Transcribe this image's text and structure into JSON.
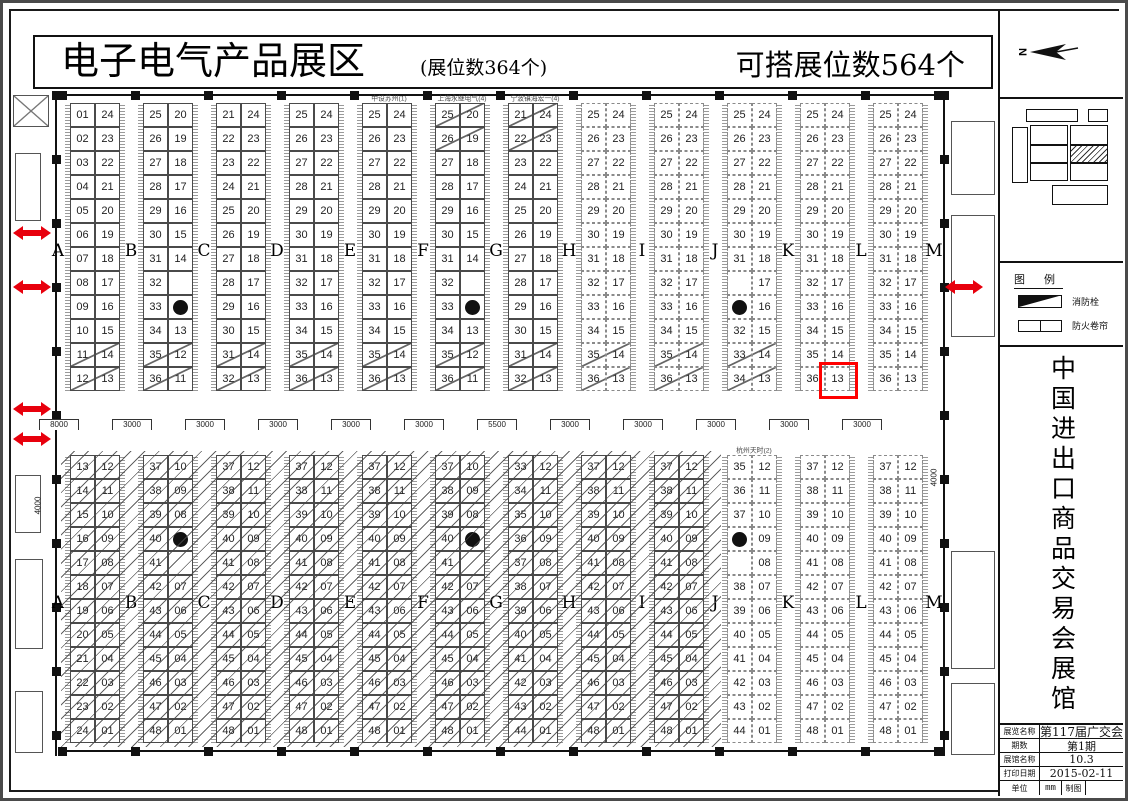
{
  "banner": {
    "title": "电子电气产品展区",
    "subtitle": "(展位数364个)",
    "right_title": "可搭展位数564个"
  },
  "letters": [
    "A",
    "B",
    "C",
    "D",
    "E",
    "F",
    "G",
    "H",
    "I",
    "J",
    "K",
    "L",
    "M"
  ],
  "top_blocks": [
    {
      "id": "A-B",
      "style": "solid",
      "header": "",
      "slash": [
        10,
        11
      ],
      "rows": [
        [
          "01",
          "24"
        ],
        [
          "02",
          "23"
        ],
        [
          "03",
          "22"
        ],
        [
          "04",
          "21"
        ],
        [
          "05",
          "20"
        ],
        [
          "06",
          "19"
        ],
        [
          "07",
          "18"
        ],
        [
          "08",
          "17"
        ],
        [
          "09",
          "16"
        ],
        [
          "10",
          "15"
        ],
        [
          "11",
          "14"
        ],
        [
          "12",
          "13"
        ]
      ]
    },
    {
      "id": "B-C",
      "style": "solid",
      "header": "",
      "slash": [
        10,
        11
      ],
      "rows": [
        [
          "25",
          "20"
        ],
        [
          "26",
          "19"
        ],
        [
          "27",
          "18"
        ],
        [
          "28",
          "17"
        ],
        [
          "29",
          "16"
        ],
        [
          "30",
          "15"
        ],
        [
          "31",
          "14"
        ],
        [
          "32",
          ""
        ],
        [
          "33",
          "P"
        ],
        [
          "34",
          "13"
        ],
        [
          "35",
          "12"
        ],
        [
          "36",
          "11"
        ]
      ]
    },
    {
      "id": "C-D",
      "style": "solid",
      "header": "",
      "slash": [
        10,
        11
      ],
      "rows": [
        [
          "21",
          "24"
        ],
        [
          "22",
          "23"
        ],
        [
          "23",
          "22"
        ],
        [
          "24",
          "21"
        ],
        [
          "25",
          "20"
        ],
        [
          "26",
          "19"
        ],
        [
          "27",
          "18"
        ],
        [
          "28",
          "17"
        ],
        [
          "29",
          "16"
        ],
        [
          "30",
          "15"
        ],
        [
          "31",
          "14"
        ],
        [
          "32",
          "13"
        ]
      ]
    },
    {
      "id": "D-E",
      "style": "solid",
      "header": "",
      "slash": [
        10,
        11
      ],
      "rows": [
        [
          "25",
          "24"
        ],
        [
          "26",
          "23"
        ],
        [
          "27",
          "22"
        ],
        [
          "28",
          "21"
        ],
        [
          "29",
          "20"
        ],
        [
          "30",
          "19"
        ],
        [
          "31",
          "18"
        ],
        [
          "32",
          "17"
        ],
        [
          "33",
          "16"
        ],
        [
          "34",
          "15"
        ],
        [
          "35",
          "14"
        ],
        [
          "36",
          "13"
        ]
      ]
    },
    {
      "id": "E-F",
      "style": "solid",
      "header": "中设苏州(1)",
      "slash": [
        10,
        11
      ],
      "rows": [
        [
          "25",
          "24"
        ],
        [
          "26",
          "23"
        ],
        [
          "27",
          "22"
        ],
        [
          "28",
          "21"
        ],
        [
          "29",
          "20"
        ],
        [
          "30",
          "19"
        ],
        [
          "31",
          "18"
        ],
        [
          "32",
          "17"
        ],
        [
          "33",
          "16"
        ],
        [
          "34",
          "15"
        ],
        [
          "35",
          "14"
        ],
        [
          "36",
          "13"
        ]
      ]
    },
    {
      "id": "F-G",
      "style": "solid",
      "header": "上海永继电气(4)",
      "slash": [
        0,
        1,
        10,
        11
      ],
      "rows": [
        [
          "25",
          "20"
        ],
        [
          "26",
          "19"
        ],
        [
          "27",
          "18"
        ],
        [
          "28",
          "17"
        ],
        [
          "29",
          "16"
        ],
        [
          "30",
          "15"
        ],
        [
          "31",
          "14"
        ],
        [
          "32",
          ""
        ],
        [
          "33",
          "P"
        ],
        [
          "34",
          "13"
        ],
        [
          "35",
          "12"
        ],
        [
          "36",
          "11"
        ]
      ]
    },
    {
      "id": "G-H",
      "style": "solid",
      "header": "宁波镇海宏一(4)",
      "slash": [
        0,
        1,
        10,
        11
      ],
      "rows": [
        [
          "21",
          "24"
        ],
        [
          "22",
          "23"
        ],
        [
          "23",
          "22"
        ],
        [
          "24",
          "21"
        ],
        [
          "25",
          "20"
        ],
        [
          "26",
          "19"
        ],
        [
          "27",
          "18"
        ],
        [
          "28",
          "17"
        ],
        [
          "29",
          "16"
        ],
        [
          "30",
          "15"
        ],
        [
          "31",
          "14"
        ],
        [
          "32",
          "13"
        ]
      ]
    },
    {
      "id": "H-I",
      "style": "dashed",
      "header": "",
      "slash": [
        10,
        11
      ],
      "rows": [
        [
          "25",
          "24"
        ],
        [
          "26",
          "23"
        ],
        [
          "27",
          "22"
        ],
        [
          "28",
          "21"
        ],
        [
          "29",
          "20"
        ],
        [
          "30",
          "19"
        ],
        [
          "31",
          "18"
        ],
        [
          "32",
          "17"
        ],
        [
          "33",
          "16"
        ],
        [
          "34",
          "15"
        ],
        [
          "35",
          "14"
        ],
        [
          "36",
          "13"
        ]
      ]
    },
    {
      "id": "I-J",
      "style": "dashed",
      "header": "",
      "slash": [
        10,
        11
      ],
      "rows": [
        [
          "25",
          "24"
        ],
        [
          "26",
          "23"
        ],
        [
          "27",
          "22"
        ],
        [
          "28",
          "21"
        ],
        [
          "29",
          "20"
        ],
        [
          "30",
          "19"
        ],
        [
          "31",
          "18"
        ],
        [
          "32",
          "17"
        ],
        [
          "33",
          "16"
        ],
        [
          "34",
          "15"
        ],
        [
          "35",
          "14"
        ],
        [
          "36",
          "13"
        ]
      ]
    },
    {
      "id": "J-K",
      "style": "dashed",
      "header": "",
      "slash": [
        10,
        11
      ],
      "rows": [
        [
          "25",
          "24"
        ],
        [
          "26",
          "23"
        ],
        [
          "27",
          "22"
        ],
        [
          "28",
          "21"
        ],
        [
          "29",
          "20"
        ],
        [
          "30",
          "19"
        ],
        [
          "31",
          "18"
        ],
        [
          "",
          "17"
        ],
        [
          "P",
          "16"
        ],
        [
          "32",
          "15"
        ],
        [
          "33",
          "14"
        ],
        [
          "34",
          "13"
        ]
      ]
    },
    {
      "id": "K-L",
      "style": "dashed",
      "header": "",
      "slash": [],
      "rows": [
        [
          "25",
          "24"
        ],
        [
          "26",
          "23"
        ],
        [
          "27",
          "22"
        ],
        [
          "28",
          "21"
        ],
        [
          "29",
          "20"
        ],
        [
          "30",
          "19"
        ],
        [
          "31",
          "18"
        ],
        [
          "32",
          "17"
        ],
        [
          "33",
          "16"
        ],
        [
          "34",
          "15"
        ],
        [
          "35",
          "14"
        ],
        [
          "36",
          "13"
        ]
      ],
      "highlight": [
        11,
        1
      ]
    },
    {
      "id": "L-M",
      "style": "dashed",
      "header": "",
      "slash": [],
      "rows": [
        [
          "25",
          "24"
        ],
        [
          "26",
          "23"
        ],
        [
          "27",
          "22"
        ],
        [
          "28",
          "21"
        ],
        [
          "29",
          "20"
        ],
        [
          "30",
          "19"
        ],
        [
          "31",
          "18"
        ],
        [
          "32",
          "17"
        ],
        [
          "33",
          "16"
        ],
        [
          "34",
          "15"
        ],
        [
          "35",
          "14"
        ],
        [
          "36",
          "13"
        ]
      ]
    }
  ],
  "bottom_blocks": [
    {
      "id": "A-B",
      "style": "solid",
      "hatched": true,
      "header": "",
      "rows": [
        [
          "13",
          "12"
        ],
        [
          "14",
          "11"
        ],
        [
          "15",
          "10"
        ],
        [
          "16",
          "09"
        ],
        [
          "17",
          "08"
        ],
        [
          "18",
          "07"
        ],
        [
          "19",
          "06"
        ],
        [
          "20",
          "05"
        ],
        [
          "21",
          "04"
        ],
        [
          "22",
          "03"
        ],
        [
          "23",
          "02"
        ],
        [
          "24",
          "01"
        ]
      ]
    },
    {
      "id": "B-C",
      "style": "solid",
      "hatched": true,
      "header": "",
      "rows": [
        [
          "37",
          "10"
        ],
        [
          "38",
          "09"
        ],
        [
          "39",
          "08"
        ],
        [
          "40",
          "P"
        ],
        [
          "41",
          ""
        ],
        [
          "42",
          "07"
        ],
        [
          "43",
          "06"
        ],
        [
          "44",
          "05"
        ],
        [
          "45",
          "04"
        ],
        [
          "46",
          "03"
        ],
        [
          "47",
          "02"
        ],
        [
          "48",
          "01"
        ]
      ]
    },
    {
      "id": "C-D",
      "style": "solid",
      "hatched": true,
      "header": "",
      "rows": [
        [
          "37",
          "12"
        ],
        [
          "38",
          "11"
        ],
        [
          "39",
          "10"
        ],
        [
          "40",
          "09"
        ],
        [
          "41",
          "08"
        ],
        [
          "42",
          "07"
        ],
        [
          "43",
          "06"
        ],
        [
          "44",
          "05"
        ],
        [
          "45",
          "04"
        ],
        [
          "46",
          "03"
        ],
        [
          "47",
          "02"
        ],
        [
          "48",
          "01"
        ]
      ]
    },
    {
      "id": "D-E",
      "style": "solid",
      "hatched": true,
      "header": "",
      "rows": [
        [
          "37",
          "12"
        ],
        [
          "38",
          "11"
        ],
        [
          "39",
          "10"
        ],
        [
          "40",
          "09"
        ],
        [
          "41",
          "08"
        ],
        [
          "42",
          "07"
        ],
        [
          "43",
          "06"
        ],
        [
          "44",
          "05"
        ],
        [
          "45",
          "04"
        ],
        [
          "46",
          "03"
        ],
        [
          "47",
          "02"
        ],
        [
          "48",
          "01"
        ]
      ]
    },
    {
      "id": "E-F",
      "style": "solid",
      "hatched": true,
      "header": "",
      "rows": [
        [
          "37",
          "12"
        ],
        [
          "38",
          "11"
        ],
        [
          "39",
          "10"
        ],
        [
          "40",
          "09"
        ],
        [
          "41",
          "08"
        ],
        [
          "42",
          "07"
        ],
        [
          "43",
          "06"
        ],
        [
          "44",
          "05"
        ],
        [
          "45",
          "04"
        ],
        [
          "46",
          "03"
        ],
        [
          "47",
          "02"
        ],
        [
          "48",
          "01"
        ]
      ]
    },
    {
      "id": "F-G",
      "style": "solid",
      "hatched": true,
      "header": "",
      "rows": [
        [
          "37",
          "10"
        ],
        [
          "38",
          "09"
        ],
        [
          "39",
          "08"
        ],
        [
          "40",
          "P"
        ],
        [
          "41",
          ""
        ],
        [
          "42",
          "07"
        ],
        [
          "43",
          "06"
        ],
        [
          "44",
          "05"
        ],
        [
          "45",
          "04"
        ],
        [
          "46",
          "03"
        ],
        [
          "47",
          "02"
        ],
        [
          "48",
          "01"
        ]
      ]
    },
    {
      "id": "G-H",
      "style": "solid",
      "hatched": true,
      "header": "",
      "rows": [
        [
          "33",
          "12"
        ],
        [
          "34",
          "11"
        ],
        [
          "35",
          "10"
        ],
        [
          "36",
          "09"
        ],
        [
          "37",
          "08"
        ],
        [
          "38",
          "07"
        ],
        [
          "39",
          "06"
        ],
        [
          "40",
          "05"
        ],
        [
          "41",
          "04"
        ],
        [
          "42",
          "03"
        ],
        [
          "43",
          "02"
        ],
        [
          "44",
          "01"
        ]
      ]
    },
    {
      "id": "H-I",
      "style": "solid",
      "hatched": true,
      "header": "",
      "rows": [
        [
          "37",
          "12"
        ],
        [
          "38",
          "11"
        ],
        [
          "39",
          "10"
        ],
        [
          "40",
          "09"
        ],
        [
          "41",
          "08"
        ],
        [
          "42",
          "07"
        ],
        [
          "43",
          "06"
        ],
        [
          "44",
          "05"
        ],
        [
          "45",
          "04"
        ],
        [
          "46",
          "03"
        ],
        [
          "47",
          "02"
        ],
        [
          "48",
          "01"
        ]
      ]
    },
    {
      "id": "I-J",
      "style": "solid",
      "hatched": true,
      "header": "",
      "rows": [
        [
          "37",
          "12"
        ],
        [
          "38",
          "11"
        ],
        [
          "39",
          "10"
        ],
        [
          "40",
          "09"
        ],
        [
          "41",
          "08"
        ],
        [
          "42",
          "07"
        ],
        [
          "43",
          "06"
        ],
        [
          "44",
          "05"
        ],
        [
          "45",
          "04"
        ],
        [
          "46",
          "03"
        ],
        [
          "47",
          "02"
        ],
        [
          "48",
          "01"
        ]
      ]
    },
    {
      "id": "J-K",
      "style": "dashed",
      "hatched": false,
      "header": "杭州天时(2)",
      "rows": [
        [
          "35",
          "12"
        ],
        [
          "36",
          "11"
        ],
        [
          "37",
          "10"
        ],
        [
          "P",
          "09"
        ],
        [
          "",
          "08"
        ],
        [
          "38",
          "07"
        ],
        [
          "39",
          "06"
        ],
        [
          "40",
          "05"
        ],
        [
          "41",
          "04"
        ],
        [
          "42",
          "03"
        ],
        [
          "43",
          "02"
        ],
        [
          "44",
          "01"
        ]
      ]
    },
    {
      "id": "K-L",
      "style": "dashed",
      "hatched": false,
      "header": "",
      "rows": [
        [
          "37",
          "12"
        ],
        [
          "38",
          "11"
        ],
        [
          "39",
          "10"
        ],
        [
          "40",
          "09"
        ],
        [
          "41",
          "08"
        ],
        [
          "42",
          "07"
        ],
        [
          "43",
          "06"
        ],
        [
          "44",
          "05"
        ],
        [
          "45",
          "04"
        ],
        [
          "46",
          "03"
        ],
        [
          "47",
          "02"
        ],
        [
          "48",
          "01"
        ]
      ]
    },
    {
      "id": "L-M",
      "style": "dashed",
      "hatched": false,
      "header": "",
      "rows": [
        [
          "37",
          "12"
        ],
        [
          "38",
          "11"
        ],
        [
          "39",
          "10"
        ],
        [
          "40",
          "09"
        ],
        [
          "41",
          "08"
        ],
        [
          "42",
          "07"
        ],
        [
          "43",
          "06"
        ],
        [
          "44",
          "05"
        ],
        [
          "45",
          "04"
        ],
        [
          "46",
          "03"
        ],
        [
          "47",
          "02"
        ],
        [
          "48",
          "01"
        ]
      ]
    }
  ],
  "dimensions": {
    "row": [
      "8000",
      "3000",
      "3000",
      "3000",
      "3000",
      "3000",
      "5500",
      "3000",
      "3000",
      "3000",
      "3000",
      "3000"
    ],
    "left_vertical": "4000",
    "right_vertical": "4000"
  },
  "highlight": {
    "booth": "13",
    "block": "K-L",
    "color": "#ff0000"
  },
  "compass": {
    "label": "N"
  },
  "sidebar": {
    "legend_title": "图 例",
    "legend": [
      {
        "icon": "fire-hydrant-symbol",
        "label": "消防栓"
      },
      {
        "icon": "fire-shutter-symbol",
        "label": "防火卷帘"
      }
    ],
    "vertical_title": "中国进出口商品交易会展馆",
    "info_table": {
      "rows": [
        [
          "展览名称",
          "第117届广交会"
        ],
        [
          "期数",
          "第1期"
        ],
        [
          "展馆名称",
          "10.3"
        ],
        [
          "打印日期",
          "2015-02-11"
        ]
      ],
      "unit_label": "单位",
      "unit_value": "mm",
      "draw_label": "制图",
      "draw_value": ""
    }
  }
}
